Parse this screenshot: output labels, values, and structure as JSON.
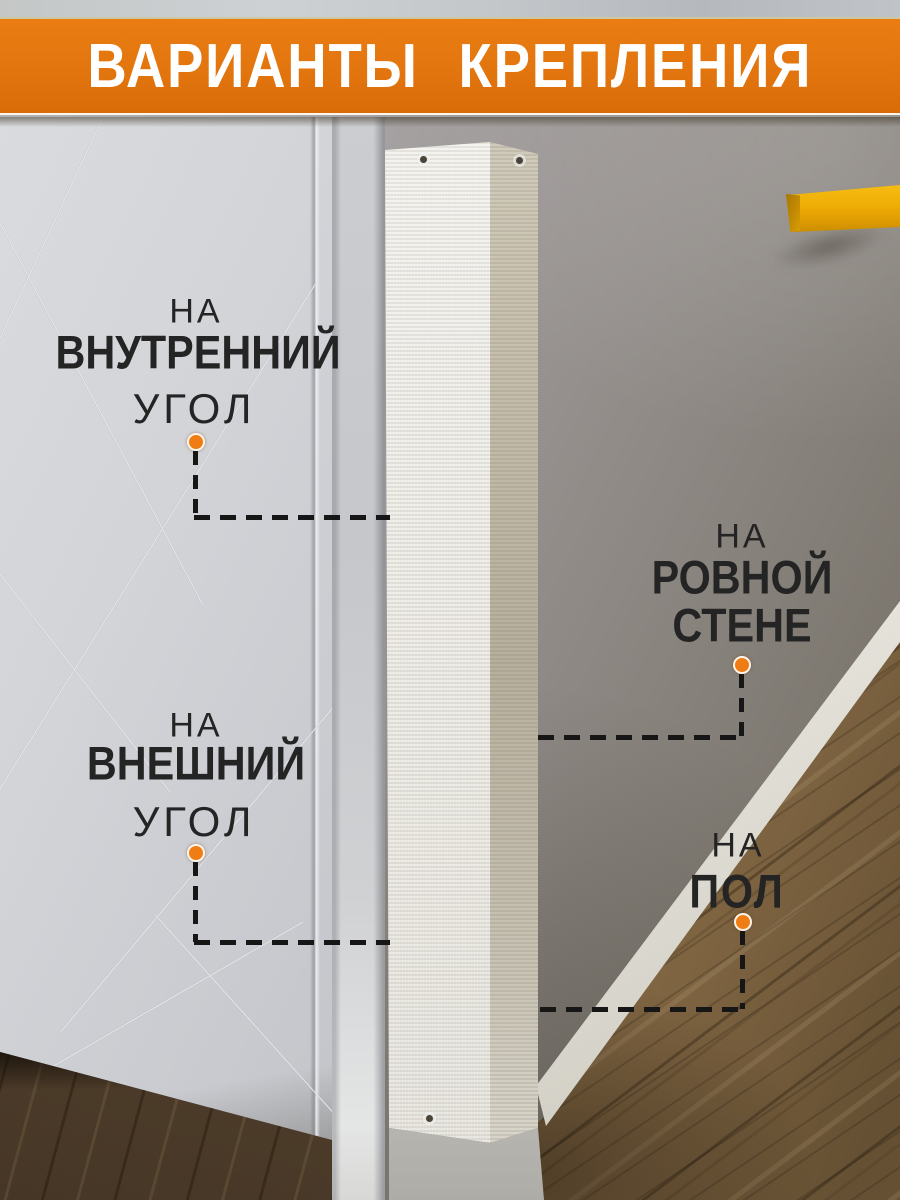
{
  "header": {
    "title": "ВАРИАНТЫ КРЕПЛЕНИЯ"
  },
  "callouts": [
    {
      "id": "inner-corner",
      "lines": [
        "НА",
        "ВНУТРЕННИЙ",
        "УГОЛ"
      ]
    },
    {
      "id": "flat-wall",
      "lines": [
        "НА",
        "РОВНОЙ",
        "СТЕНЕ"
      ]
    },
    {
      "id": "outer-corner",
      "lines": [
        "НА",
        "ВНЕШНИЙ",
        "УГОЛ"
      ]
    },
    {
      "id": "floor",
      "lines": [
        "НА",
        "ПОЛ"
      ]
    }
  ],
  "colors": {
    "banner_orange": "#E2750E",
    "marker_orange": "#F07D14",
    "dash_black": "#161616",
    "shelf_yellow": "#EFAD06",
    "text_dark": "#242424"
  }
}
